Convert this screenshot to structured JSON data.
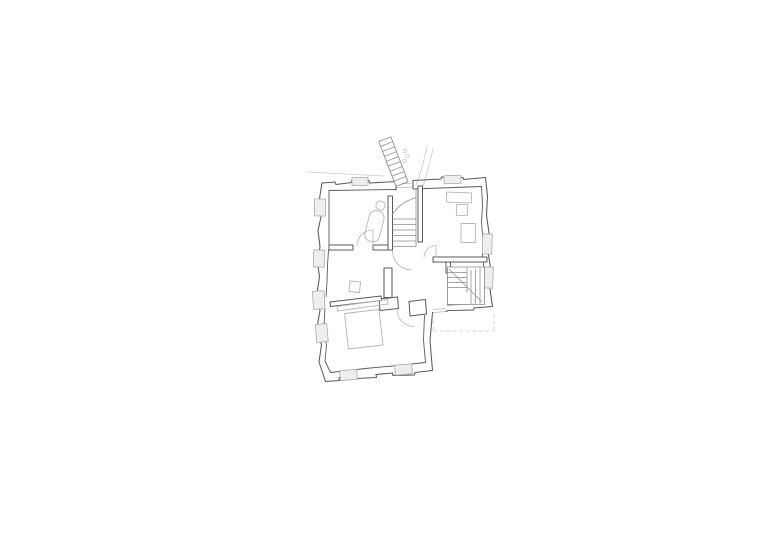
{
  "page": {
    "background": "#ffffff"
  },
  "drawing": {
    "type": "architectural-floor-plan",
    "visible_text": "",
    "features": [
      "external-staircase",
      "entry-landing",
      "bathroom-with-tub",
      "main-room-upper-right",
      "central-stair-hall",
      "secondary-staircase",
      "lower-wing-room",
      "terrace-dashed-outline"
    ]
  },
  "colors": {
    "background": "#ffffff",
    "wall-line": "#5a5a5a",
    "interior-line": "#8c8c8c",
    "fixture-line": "#b5b5b5",
    "faint-line": "#cacaca",
    "window-fill": "#eeeeee"
  }
}
